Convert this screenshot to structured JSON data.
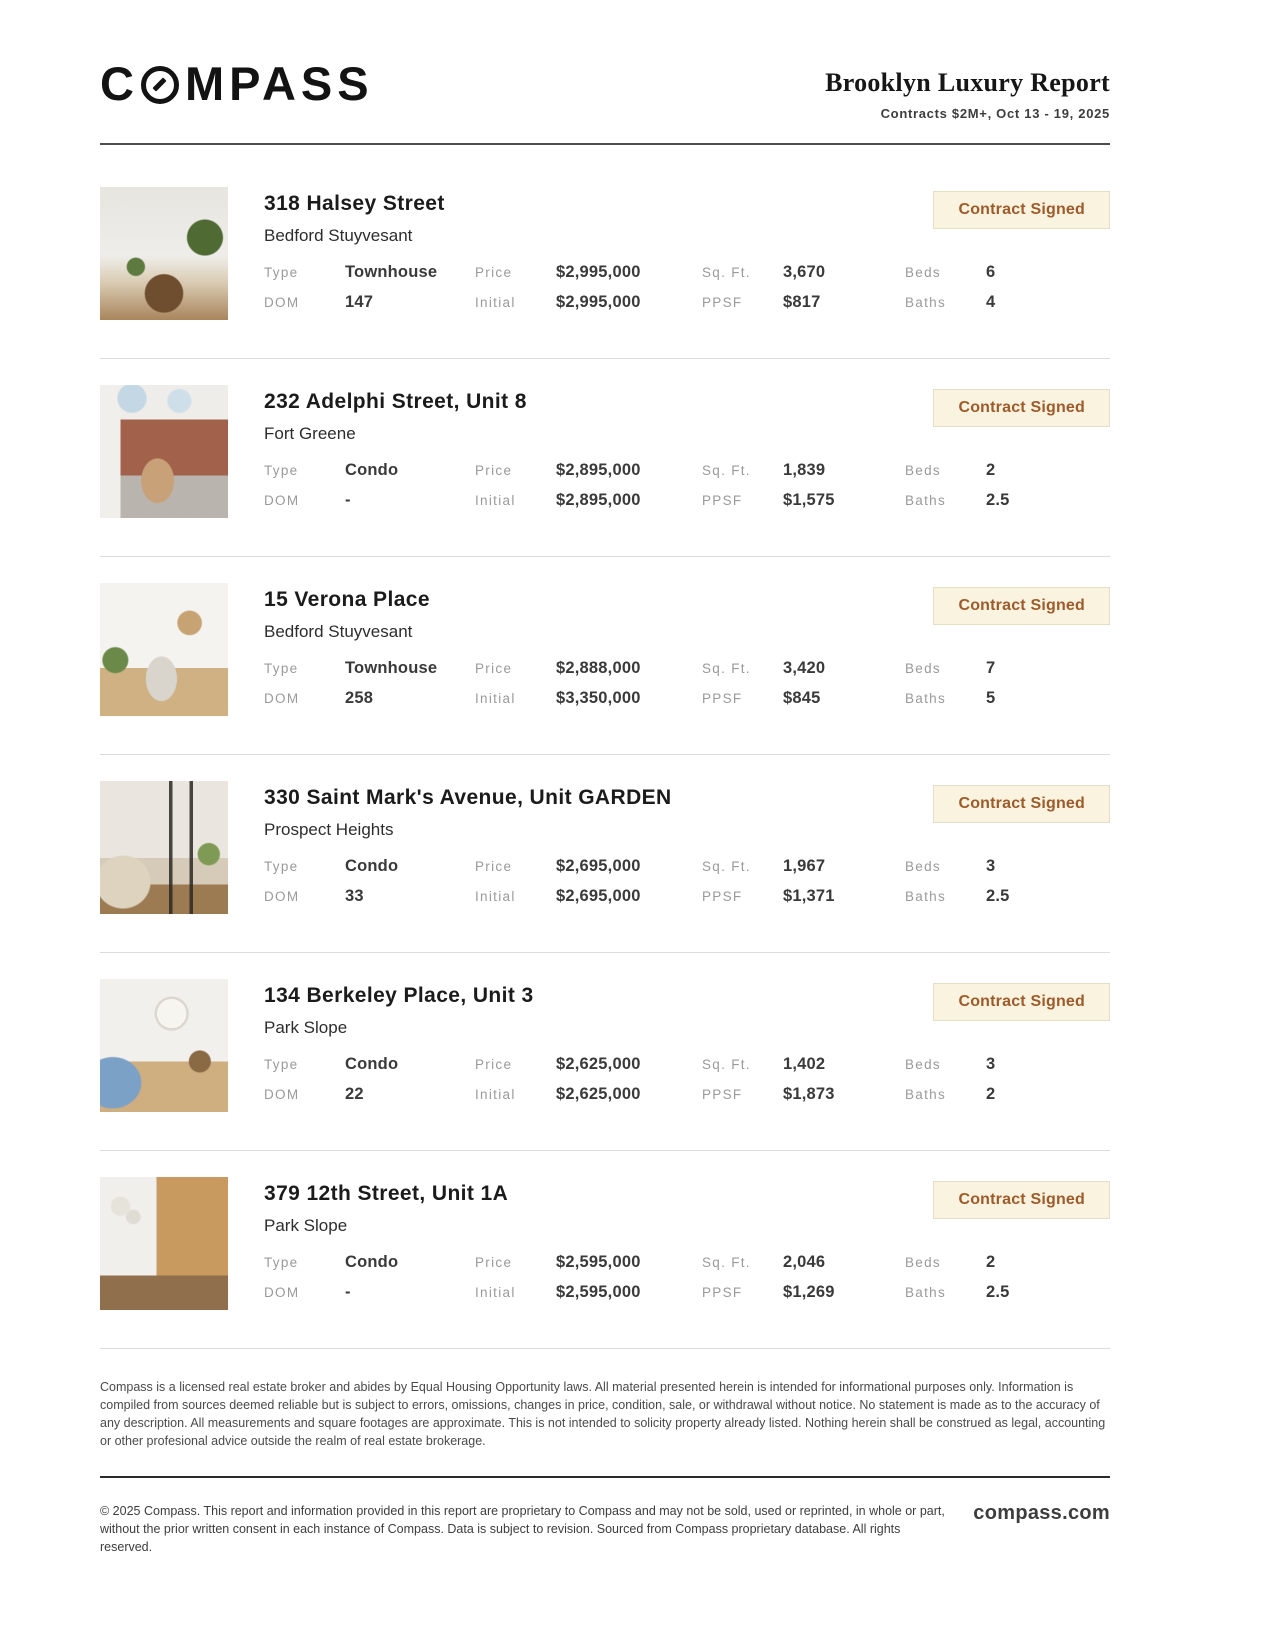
{
  "header": {
    "logo_c": "C",
    "logo_mpass": "MPASS",
    "title": "Brooklyn Luxury Report",
    "subtitle": "Contracts $2M+, Oct 13 - 19, 2025"
  },
  "labels": {
    "type": "Type",
    "dom": "DOM",
    "price": "Price",
    "initial": "Initial",
    "sqft": "Sq. Ft.",
    "ppsf": "PPSF",
    "beds": "Beds",
    "baths": "Baths"
  },
  "listings": [
    {
      "address": "318 Halsey Street",
      "neighborhood": "Bedford Stuyvesant",
      "status": "Contract Signed",
      "photo": "living-room-with-wood-chairs-and-plants",
      "type": "Townhouse",
      "dom": "147",
      "price": "$2,995,000",
      "initial": "$2,995,000",
      "sqft": "3,670",
      "ppsf": "$817",
      "beds": "6",
      "baths": "4"
    },
    {
      "address": "232 Adelphi Street, Unit 8",
      "neighborhood": "Fort Greene",
      "status": "Contract Signed",
      "photo": "loft-with-brick-wall-and-skylights",
      "type": "Condo",
      "dom": "-",
      "price": "$2,895,000",
      "initial": "$2,895,000",
      "sqft": "1,839",
      "ppsf": "$1,575",
      "beds": "2",
      "baths": "2.5"
    },
    {
      "address": "15 Verona Place",
      "neighborhood": "Bedford Stuyvesant",
      "status": "Contract Signed",
      "photo": "white-kitchen-with-plants",
      "type": "Townhouse",
      "dom": "258",
      "price": "$2,888,000",
      "initial": "$3,350,000",
      "sqft": "3,420",
      "ppsf": "$845",
      "beds": "7",
      "baths": "5"
    },
    {
      "address": "330 Saint Mark's Avenue, Unit GARDEN",
      "neighborhood": "Prospect Heights",
      "status": "Contract Signed",
      "photo": "living-room-with-black-framed-glass-doors",
      "type": "Condo",
      "dom": "33",
      "price": "$2,695,000",
      "initial": "$2,695,000",
      "sqft": "1,967",
      "ppsf": "$1,371",
      "beds": "3",
      "baths": "2.5"
    },
    {
      "address": "134 Berkeley Place, Unit 3",
      "neighborhood": "Park Slope",
      "status": "Contract Signed",
      "photo": "parlor-with-blue-sofa-and-paper-lantern",
      "type": "Condo",
      "dom": "22",
      "price": "$2,625,000",
      "initial": "$2,625,000",
      "sqft": "1,402",
      "ppsf": "$1,873",
      "beds": "3",
      "baths": "2"
    },
    {
      "address": "379 12th Street, Unit 1A",
      "neighborhood": "Park Slope",
      "status": "Contract Signed",
      "photo": "kitchen-with-wood-cabinets",
      "type": "Condo",
      "dom": "-",
      "price": "$2,595,000",
      "initial": "$2,595,000",
      "sqft": "2,046",
      "ppsf": "$1,269",
      "beds": "2",
      "baths": "2.5"
    }
  ],
  "footer": {
    "disclaimer": "Compass is a licensed real estate broker and abides by Equal Housing Opportunity laws. All material presented herein is intended for informational purposes only. Information is compiled from sources deemed reliable but is subject to errors, omissions, changes in price, condition, sale, or withdrawal without notice. No statement is made as to the accuracy of any description. All measurements and square footages are approximate. This is not intended to solicity property already listed. Nothing herein shall be construed as legal, accounting or other profesional advice outside the realm of real estate brokerage.",
    "copyright": "© 2025 Compass. This report and information provided in this report are proprietary to Compass and may not be sold, used or reprinted, in whole or part, without the prior written consent in each instance of Compass. Data is subject to revision. Sourced from Compass proprietary database. All rights reserved.",
    "site": "compass.com"
  },
  "colors": {
    "badge_background": "#FAF3DF",
    "badge_border": "#E6DDC6",
    "badge_text": "#9D5B2B",
    "divider": "#DCDCDC",
    "header_rule": "#4D4D4D",
    "label_gray": "#9A9A9A",
    "text_dark": "#1B1B1B"
  }
}
